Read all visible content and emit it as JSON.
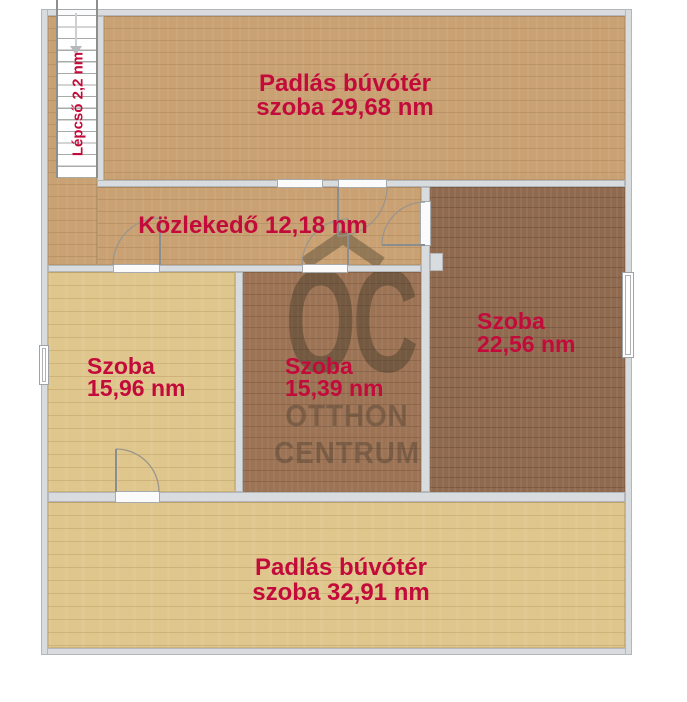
{
  "plan": {
    "type": "floor-plan",
    "rooms": {
      "attic_top": {
        "line1": "Padlás búvótér",
        "line2": "szoba 29,68 nm"
      },
      "corridor": {
        "line1": "Közlekedő 12,18 nm"
      },
      "room_left": {
        "line1": "Szoba",
        "line2": "15,96 nm"
      },
      "room_middle": {
        "line1": "Szoba",
        "line2": "15,39 nm"
      },
      "room_right": {
        "line1": "Szoba",
        "line2": "22,56 nm"
      },
      "attic_bottom": {
        "line1": "Padlás búvótér",
        "line2": "szoba 32,91 nm"
      },
      "stairs": {
        "label": "Lépcső 2,2 nm"
      }
    },
    "watermark": {
      "initials": "OC",
      "line1": "OTTHON",
      "line2": "CENTRUM"
    },
    "icons": {
      "stairs_arrow": "down-arrow",
      "watermark_roof": "roof-chevron"
    },
    "colors": {
      "label_accent": "#C30B3B",
      "wall": "#D9DCDF",
      "floor_oak": "#C9A173",
      "floor_light_oak": "#DFC68C",
      "floor_brown": "#9C7354",
      "floor_dark_brown": "#8F6A4F",
      "watermark": "#3A3226",
      "background": "#FFFFFF"
    }
  }
}
